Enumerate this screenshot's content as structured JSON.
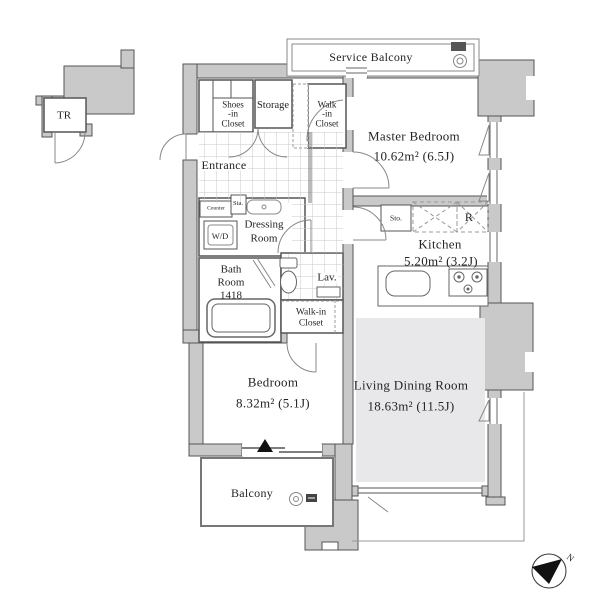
{
  "colors": {
    "wall_fill": "#c9c9c9",
    "wall_stroke": "#555555",
    "rug": "#e8e8ea",
    "thin_line": "#888888",
    "text": "#242424"
  },
  "rooms": {
    "master_bedroom": {
      "name": "Master Bedroom",
      "area": "10.62m²  (6.5J)"
    },
    "kitchen": {
      "name": "Kitchen",
      "area": "5.20m²  (3.2J)"
    },
    "living_dining_room": {
      "name": "Living Dining Room",
      "area": "18.63m²  (11.5J)"
    },
    "bedroom": {
      "name": "Bedroom",
      "area": "8.32m²  (5.1J)"
    }
  },
  "spaces": {
    "service_balcony": "Service Balcony",
    "balcony": "Balcony",
    "entrance": "Entrance",
    "trunk_room": "TR",
    "storage": "Storage",
    "shoes_in_closet": {
      "l1": "Shoes",
      "l2": "-in",
      "l3": "Closet"
    },
    "walk_in_closet_top": {
      "l1": "Walk",
      "l2": "-in",
      "l3": "Closet"
    },
    "walk_in_closet_mid": {
      "l1": "Walk-in",
      "l2": "Closet"
    },
    "dressing_room": {
      "l1": "Dressing",
      "l2": "Room"
    },
    "bath_room": {
      "l1": "Bath",
      "l2": "Room",
      "l3": "1418"
    },
    "lavatory": "Lav.",
    "counter": "Counter",
    "station_box": "Sta.",
    "washer_dryer": "W/D",
    "storage_small": "Sto.",
    "refrigerator": "R"
  },
  "compass": {
    "n": "N"
  }
}
